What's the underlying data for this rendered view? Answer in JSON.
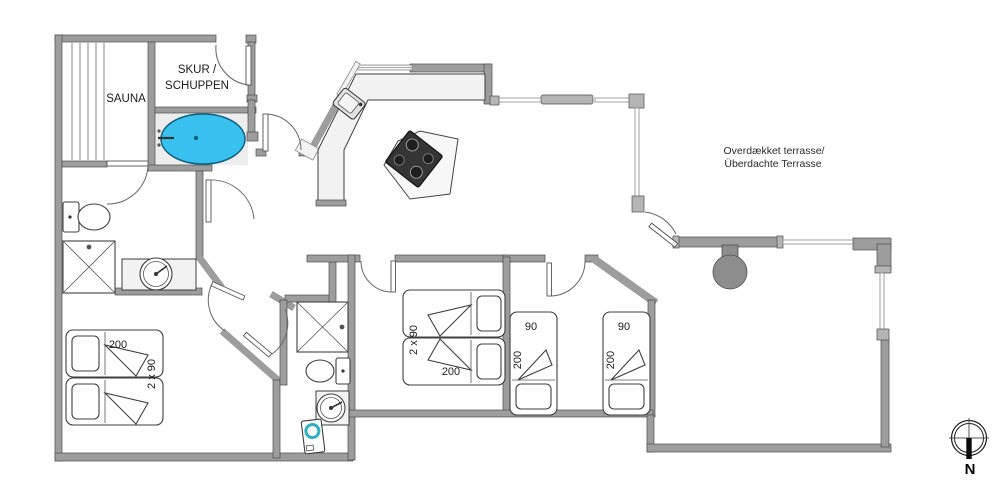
{
  "labels": {
    "sauna": "SAUNA",
    "shed_line1": "SKUR /",
    "shed_line2": "SCHUPPEN",
    "terrace_line1": "Overdækket terrasse/",
    "terrace_line2": "Überdachte Terrasse",
    "compass_north": "N"
  },
  "beds": {
    "sw_double": {
      "length": "200",
      "width": "2 x 90"
    },
    "mid_double": {
      "width": "2 x 90",
      "length": "200"
    },
    "east_left": {
      "width": "90",
      "length": "200"
    },
    "east_right": {
      "width": "90",
      "length": "200"
    }
  },
  "colors": {
    "wall": "#9d9d9d",
    "tub": "#38c0ee",
    "tub_edge": "#0f5f7e",
    "washer_accent": "#2fb0c6",
    "grill": "#8d8d8d",
    "cooktop": "#353535",
    "floor_accent": "#ededed"
  }
}
